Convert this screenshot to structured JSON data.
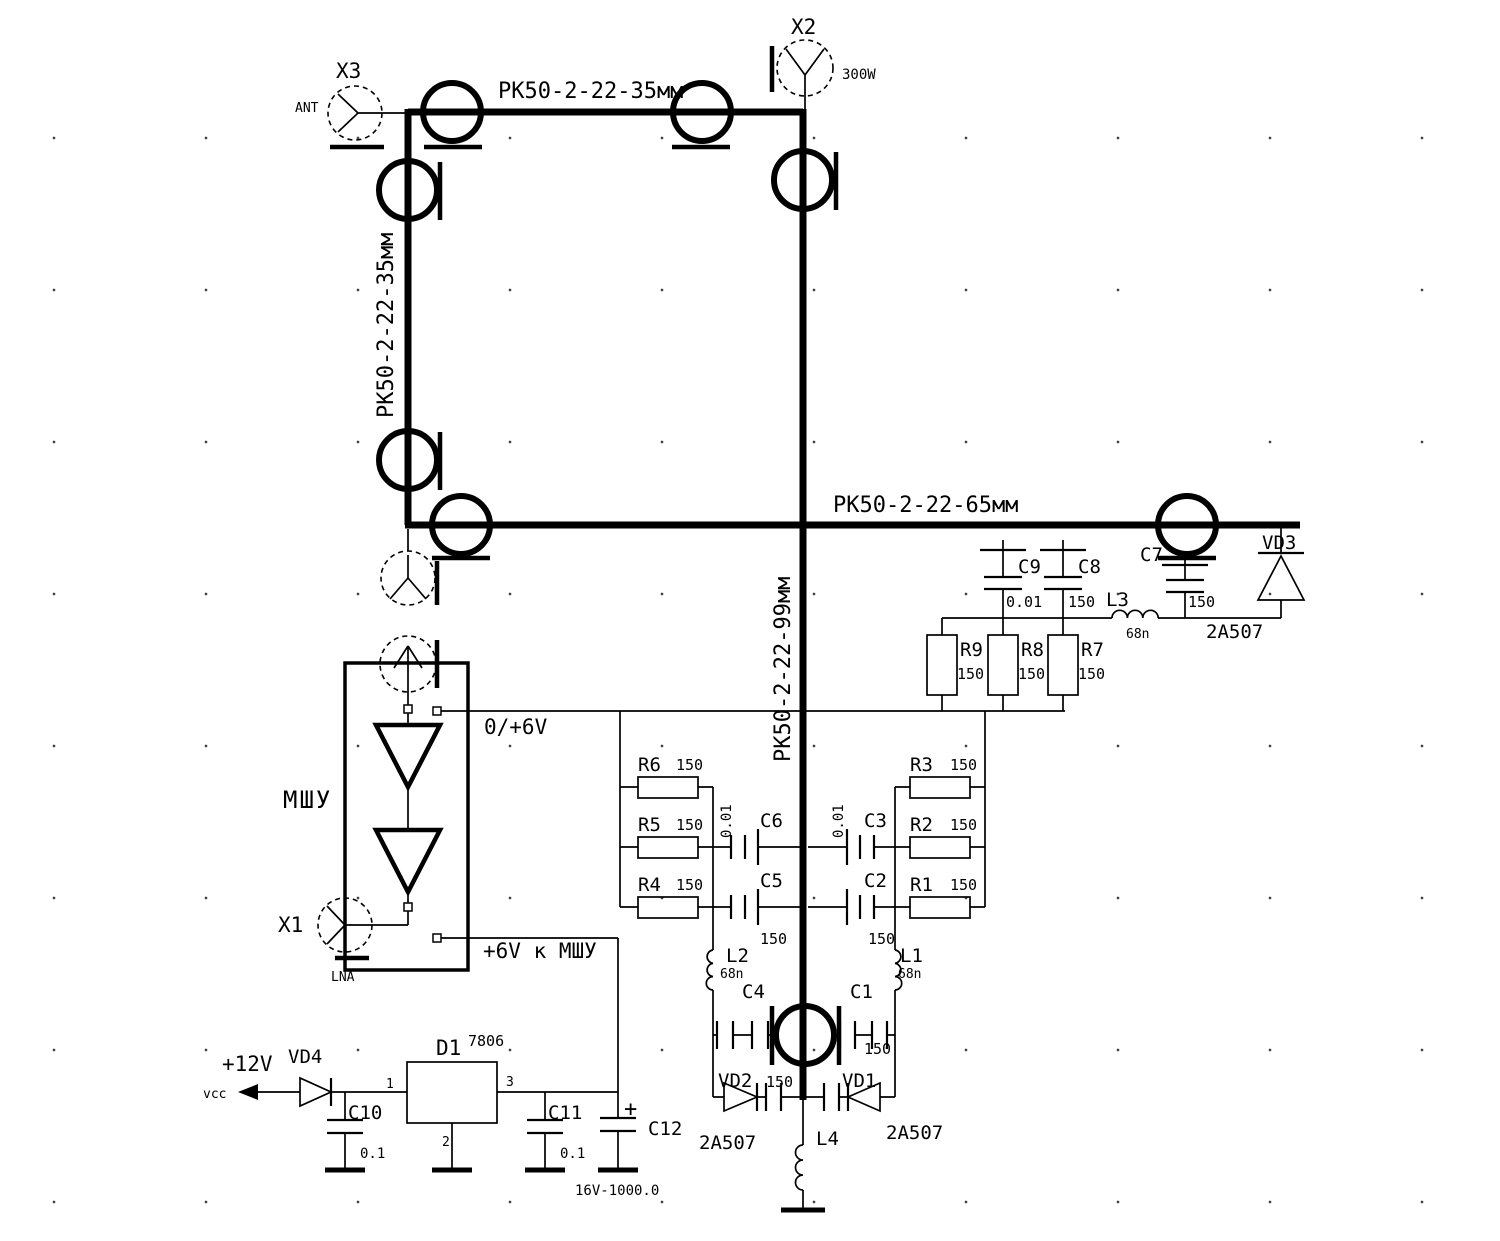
{
  "cables": {
    "top": "РК50-2-22-35мм",
    "left": "РК50-2-22-35мм",
    "right": "РК50-2-22-65мм",
    "center": "РК50-2-22-99мм"
  },
  "connectors": {
    "x3": {
      "ref": "X3",
      "port": "ANT"
    },
    "x2": {
      "ref": "X2",
      "power": "300W"
    },
    "x1": {
      "ref": "X1",
      "port": "LNA"
    }
  },
  "amplifier": {
    "name": "МШУ",
    "control_net": "0/+6V",
    "supply_net": "+6V к МШУ"
  },
  "resistors": {
    "r1": {
      "ref": "R1",
      "value": "150"
    },
    "r2": {
      "ref": "R2",
      "value": "150"
    },
    "r3": {
      "ref": "R3",
      "value": "150"
    },
    "r4": {
      "ref": "R4",
      "value": "150"
    },
    "r5": {
      "ref": "R5",
      "value": "150"
    },
    "r6": {
      "ref": "R6",
      "value": "150"
    },
    "r7": {
      "ref": "R7",
      "value": "150"
    },
    "r8": {
      "ref": "R8",
      "value": "150"
    },
    "r9": {
      "ref": "R9",
      "value": "150"
    }
  },
  "capacitors": {
    "c1": {
      "ref": "C1",
      "value": "150"
    },
    "c2": {
      "ref": "C2",
      "value": "150"
    },
    "c3": {
      "ref": "C3",
      "value": "0.01"
    },
    "c4": {
      "ref": "C4",
      "value": "150"
    },
    "c5": {
      "ref": "C5",
      "value": "150"
    },
    "c6": {
      "ref": "C6",
      "value": "0.01"
    },
    "c7": {
      "ref": "C7",
      "value": "150"
    },
    "c8": {
      "ref": "C8",
      "value": "150"
    },
    "c9": {
      "ref": "C9",
      "value": "0.01"
    },
    "c10": {
      "ref": "C10",
      "value": "0.1"
    },
    "c11": {
      "ref": "C11",
      "value": "0.1"
    },
    "c12": {
      "ref": "C12",
      "value": "16V-1000.0",
      "polarity": "+"
    }
  },
  "inductors": {
    "l1": {
      "ref": "L1",
      "value": "68n"
    },
    "l2": {
      "ref": "L2",
      "value": "68n"
    },
    "l3": {
      "ref": "L3",
      "value": "68n"
    },
    "l4": {
      "ref": "L4"
    }
  },
  "diodes": {
    "vd1": {
      "ref": "VD1",
      "part": "2А507"
    },
    "vd2": {
      "ref": "VD2",
      "part": "2А507"
    },
    "vd3": {
      "ref": "VD3",
      "part": "2А507"
    },
    "vd4": {
      "ref": "VD4"
    }
  },
  "power": {
    "rail": "+12V",
    "net": "vcc",
    "regulator": {
      "ref": "D1",
      "part": "7806",
      "pin_in": "1",
      "pin_gnd": "2",
      "pin_out": "3"
    }
  }
}
